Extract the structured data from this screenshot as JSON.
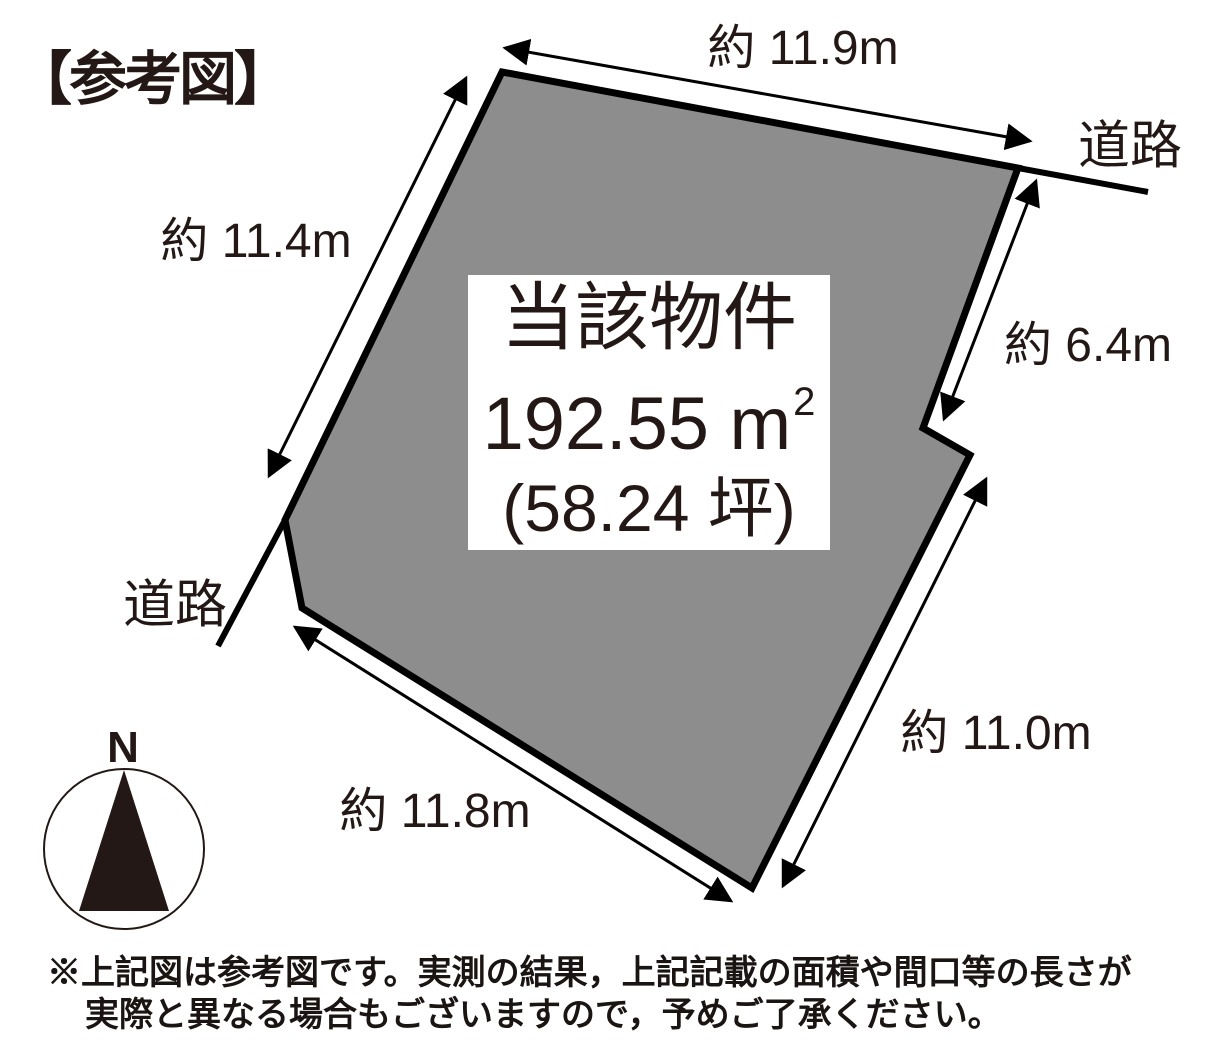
{
  "title": "【参考図】",
  "colors": {
    "land_fill": "#8d8d8d",
    "outline": "#000000",
    "ink": "#231815"
  },
  "parcel": {
    "name": "当該物件",
    "area_main": "192.55 m",
    "area_sup": "2",
    "area_tsubo": "(58.24 坪)"
  },
  "dimensions": {
    "top": "約 11.9m",
    "left": "約 11.4m",
    "right_upper": "約 6.4m",
    "right_lower": "約 11.0m",
    "bottom": "約 11.8m"
  },
  "roads": {
    "top_right": "道路",
    "left": "道路"
  },
  "compass": {
    "north": "N"
  },
  "disclaimer": {
    "line1": "※上記図は参考図です。実測の結果，上記記載の面積や間口等の長さが",
    "line2": "実際と異なる場合もございますので，予めご了承ください。"
  }
}
